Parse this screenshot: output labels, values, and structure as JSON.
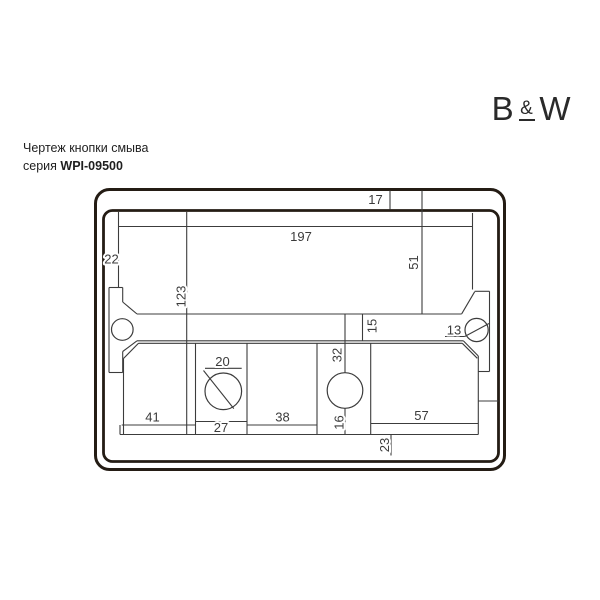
{
  "logo": {
    "left": "B",
    "amp": "&",
    "right": "W"
  },
  "caption": {
    "line1": "Чертеж кнопки смыва",
    "series_prefix": "серия ",
    "series_code": "WPI-09500"
  },
  "drawing": {
    "kind": "dimensioned technical drawing of a flush button plate",
    "colors": {
      "thick_line": "#241c14",
      "thin_line": "#3c3c3c",
      "label": "#3b3b3b",
      "background": "#ffffff"
    },
    "dimensions": [
      {
        "label": "17",
        "x": 375.5,
        "y": 204,
        "rotated": false
      },
      {
        "label": "197",
        "x": 301,
        "y": 241,
        "rotated": false
      },
      {
        "label": "22",
        "x": 111.5,
        "y": 263.5,
        "rotated": false
      },
      {
        "label": "51",
        "x": 418,
        "y": 262.5,
        "rotated": true
      },
      {
        "label": "123",
        "x": 185.5,
        "y": 296.5,
        "rotated": true
      },
      {
        "label": "15",
        "x": 376.5,
        "y": 326,
        "rotated": true
      },
      {
        "label": "13",
        "x": 454,
        "y": 334.5,
        "rotated": false
      },
      {
        "label": "32",
        "x": 341.5,
        "y": 355,
        "rotated": true
      },
      {
        "label": "20",
        "x": 222.5,
        "y": 366,
        "rotated": false
      },
      {
        "label": "41",
        "x": 152.5,
        "y": 421.5,
        "rotated": false
      },
      {
        "label": "27",
        "x": 221,
        "y": 432,
        "rotated": false
      },
      {
        "label": "38",
        "x": 282.5,
        "y": 421.5,
        "rotated": false
      },
      {
        "label": "16",
        "x": 343.5,
        "y": 422.5,
        "rotated": true
      },
      {
        "label": "57",
        "x": 421.5,
        "y": 420,
        "rotated": false
      },
      {
        "label": "23",
        "x": 389,
        "y": 445,
        "rotated": true
      }
    ]
  }
}
